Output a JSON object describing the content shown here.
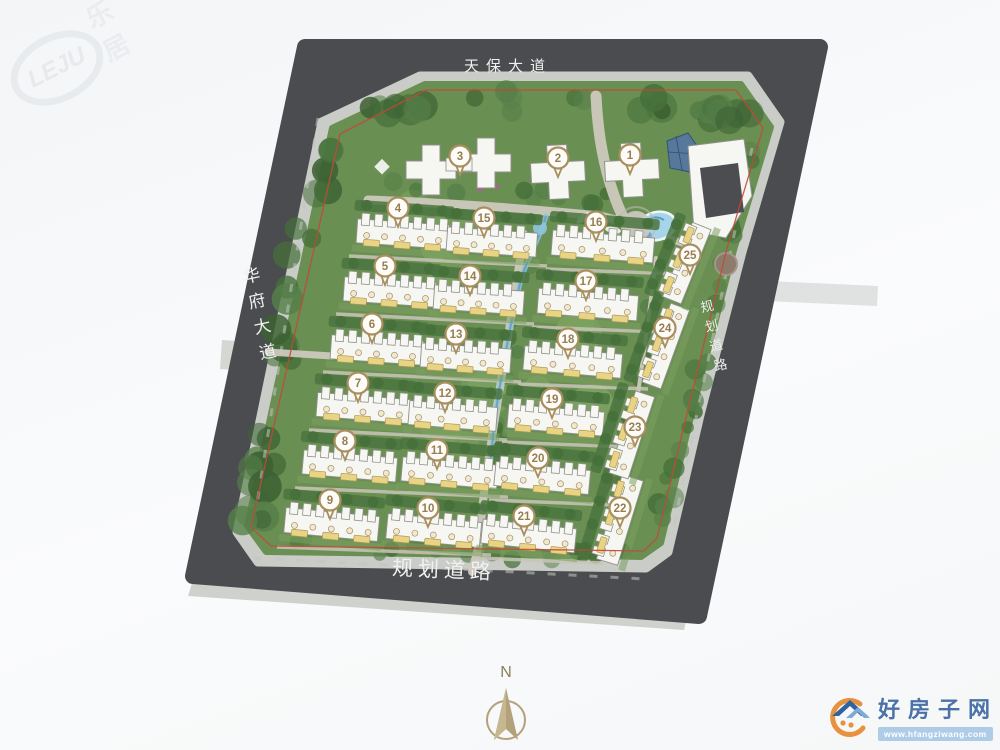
{
  "roads": {
    "top": {
      "label": "天保大道"
    },
    "left": {
      "label": "华府大道"
    },
    "right": {
      "label": "规划道路"
    },
    "bottom": {
      "label": "规划道路"
    }
  },
  "compass": {
    "label": "N"
  },
  "watermark": {
    "logo_text": "LEJU",
    "cn_text": "乐居"
  },
  "site_logo": {
    "name": "好房子网",
    "url": "www.hfangziwang.com"
  },
  "colors": {
    "road": "#4a4c4f",
    "sidewalk": "#c9ccc7",
    "outer_walk": "#ced1cc",
    "green": "#6a8f52",
    "tree_dark": "#46703a",
    "tree_mid": "#568049",
    "tree_deep": "#3c6133",
    "lawn_light": "#7da361",
    "building": "#f6f7f3",
    "building_outline": "#90928a",
    "path": "#d0ccc0",
    "lane": "#cac5b9",
    "water": "#8fc4dd",
    "water_deep": "#5d9cc3",
    "pool": "#a7d4e8",
    "boundary": "#c04a39",
    "badge_ring": "#a98e5e",
    "badge_text": "#967d52",
    "unit_dot": "#f1e8cf",
    "unit_dot_ring": "#a5906a",
    "unit_label": "#e9d385",
    "unit_label_border": "#b19a54",
    "compass": "#b2a17b",
    "logo_blue": "#4a72a8",
    "logo_roof_dark": "#30629f",
    "logo_roof_light": "#7fa9d6",
    "logo_orange": "#e8913f",
    "logo_band": "#aecce8"
  },
  "buildings": [
    {
      "num": 1,
      "kind": "tower",
      "cx": 632,
      "cy": 170,
      "arm": 27,
      "t": 10,
      "badge": [
        630,
        155
      ]
    },
    {
      "num": 2,
      "kind": "tower",
      "cx": 558,
      "cy": 172,
      "arm": 27,
      "t": 10,
      "badge": [
        558,
        158
      ]
    },
    {
      "num": 3,
      "kind": "tower2",
      "plus": [
        [
          431,
          170
        ],
        [
          486,
          163
        ]
      ],
      "arm": 25,
      "t": 9,
      "badge": [
        460,
        156
      ]
    },
    {
      "num": 4,
      "kind": "row",
      "x": 357,
      "y": 216,
      "w": 92,
      "h": 30,
      "angle": 4,
      "badge": [
        398,
        208
      ]
    },
    {
      "num": 5,
      "kind": "row",
      "x": 344,
      "y": 274,
      "w": 92,
      "h": 30,
      "angle": 4,
      "badge": [
        385,
        266
      ]
    },
    {
      "num": 6,
      "kind": "row",
      "x": 331,
      "y": 332,
      "w": 92,
      "h": 30,
      "angle": 4,
      "badge": [
        372,
        324
      ]
    },
    {
      "num": 7,
      "kind": "row",
      "x": 317,
      "y": 390,
      "w": 93,
      "h": 30,
      "angle": 4.5,
      "badge": [
        358,
        383
      ]
    },
    {
      "num": 8,
      "kind": "row",
      "x": 303,
      "y": 448,
      "w": 94,
      "h": 30,
      "angle": 5,
      "badge": [
        345,
        441
      ]
    },
    {
      "num": 9,
      "kind": "row",
      "x": 285,
      "y": 506,
      "w": 94,
      "h": 31,
      "angle": 5.5,
      "badge": [
        330,
        500
      ]
    },
    {
      "num": 10,
      "kind": "row",
      "x": 387,
      "y": 512,
      "w": 94,
      "h": 31,
      "angle": 5.5,
      "badge": [
        428,
        508
      ]
    },
    {
      "num": 11,
      "kind": "row",
      "x": 402,
      "y": 455,
      "w": 96,
      "h": 30,
      "angle": 5,
      "badge": [
        437,
        450
      ]
    },
    {
      "num": 12,
      "kind": "row",
      "x": 409,
      "y": 398,
      "w": 88,
      "h": 30,
      "angle": 4.5,
      "badge": [
        445,
        393
      ]
    },
    {
      "num": 13,
      "kind": "row",
      "x": 421,
      "y": 340,
      "w": 90,
      "h": 30,
      "angle": 4,
      "badge": [
        456,
        334
      ]
    },
    {
      "num": 14,
      "kind": "row",
      "x": 434,
      "y": 282,
      "w": 90,
      "h": 30,
      "angle": 4,
      "badge": [
        470,
        276
      ]
    },
    {
      "num": 15,
      "kind": "row",
      "x": 447,
      "y": 224,
      "w": 90,
      "h": 30,
      "angle": 4,
      "badge": [
        484,
        218
      ]
    },
    {
      "num": 16,
      "kind": "row",
      "x": 552,
      "y": 228,
      "w": 102,
      "h": 31,
      "angle": 4.5,
      "badge": [
        596,
        222
      ]
    },
    {
      "num": 17,
      "kind": "row",
      "x": 538,
      "y": 286,
      "w": 100,
      "h": 31,
      "angle": 4.5,
      "badge": [
        586,
        281
      ]
    },
    {
      "num": 18,
      "kind": "row",
      "x": 524,
      "y": 344,
      "w": 98,
      "h": 30,
      "angle": 5,
      "badge": [
        568,
        339
      ]
    },
    {
      "num": 19,
      "kind": "row",
      "x": 508,
      "y": 402,
      "w": 96,
      "h": 30,
      "angle": 5,
      "badge": [
        552,
        399
      ]
    },
    {
      "num": 20,
      "kind": "row",
      "x": 495,
      "y": 460,
      "w": 95,
      "h": 30,
      "angle": 5.5,
      "badge": [
        538,
        458
      ]
    },
    {
      "num": 21,
      "kind": "row",
      "x": 482,
      "y": 518,
      "w": 94,
      "h": 30,
      "angle": 6,
      "badge": [
        524,
        516
      ]
    },
    {
      "num": 22,
      "kind": "vrow",
      "cx": 617,
      "cy": 519,
      "w": 88,
      "h": 28,
      "angle": -73,
      "badge": [
        620,
        508
      ]
    },
    {
      "num": 23,
      "kind": "vrow",
      "cx": 629,
      "cy": 434,
      "w": 86,
      "h": 26,
      "angle": -72,
      "badge": [
        635,
        427
      ]
    },
    {
      "num": 24,
      "kind": "vrow",
      "cx": 663,
      "cy": 345,
      "w": 84,
      "h": 26,
      "angle": -70,
      "badge": [
        665,
        328
      ]
    },
    {
      "num": 25,
      "kind": "vrow",
      "cx": 684,
      "cy": 262,
      "w": 80,
      "h": 26,
      "angle": -68,
      "badge": [
        690,
        255
      ]
    }
  ]
}
